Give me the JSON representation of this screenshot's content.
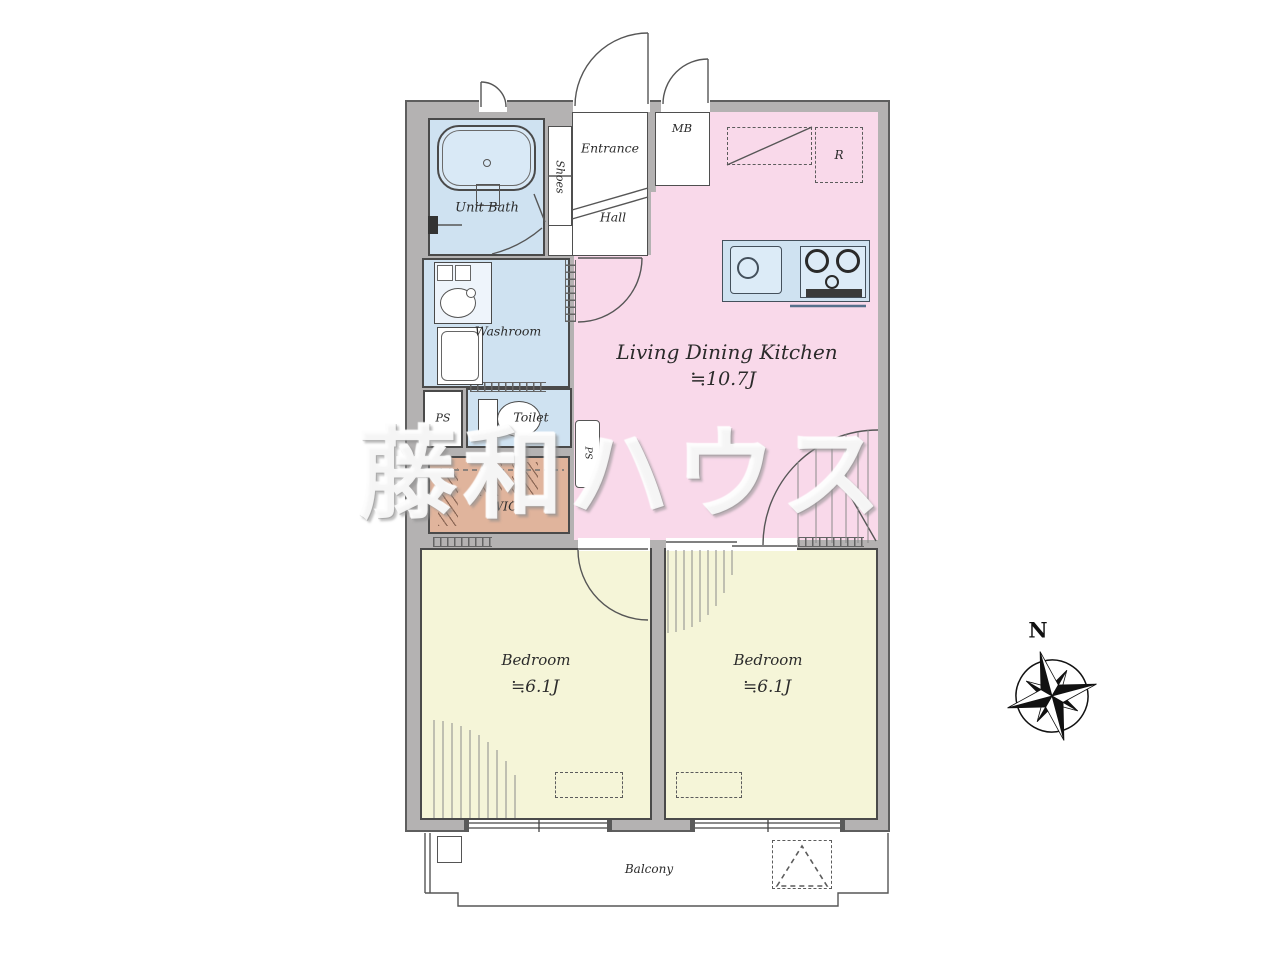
{
  "watermark": {
    "text": "藤和ハウス"
  },
  "compass": {
    "north_label": "N"
  },
  "plan": {
    "unit_bath": {
      "label": "Unit Bath"
    },
    "shoes": {
      "label": "Shoes"
    },
    "entrance": {
      "label": "Entrance"
    },
    "hall": {
      "label": "Hall"
    },
    "meter_box": {
      "label": "MB"
    },
    "refrigerator": {
      "label": "R"
    },
    "ldk": {
      "label": "Living Dining Kitchen",
      "area": "≒10.7J"
    },
    "washroom": {
      "label": "Washroom"
    },
    "pipe_space": {
      "label": "PS"
    },
    "pipe_space_column": {
      "label": "PS"
    },
    "toilet": {
      "label": "Toilet"
    },
    "walk_in_closet": {
      "label": "WIC"
    },
    "bedroom_left": {
      "label": "Bedroom",
      "area": "≒6.1J"
    },
    "bedroom_right": {
      "label": "Bedroom",
      "area": "≒6.1J"
    },
    "balcony": {
      "label": "Balcony"
    }
  },
  "colors": {
    "wall": "#b4b2b2",
    "wet_area": "#cfe2f1",
    "wet_light": "#dcebf7",
    "ldk": "#f9d9ea",
    "bedroom": "#f5f5d8",
    "wic": "#e0b49c",
    "white": "#ffffff"
  }
}
